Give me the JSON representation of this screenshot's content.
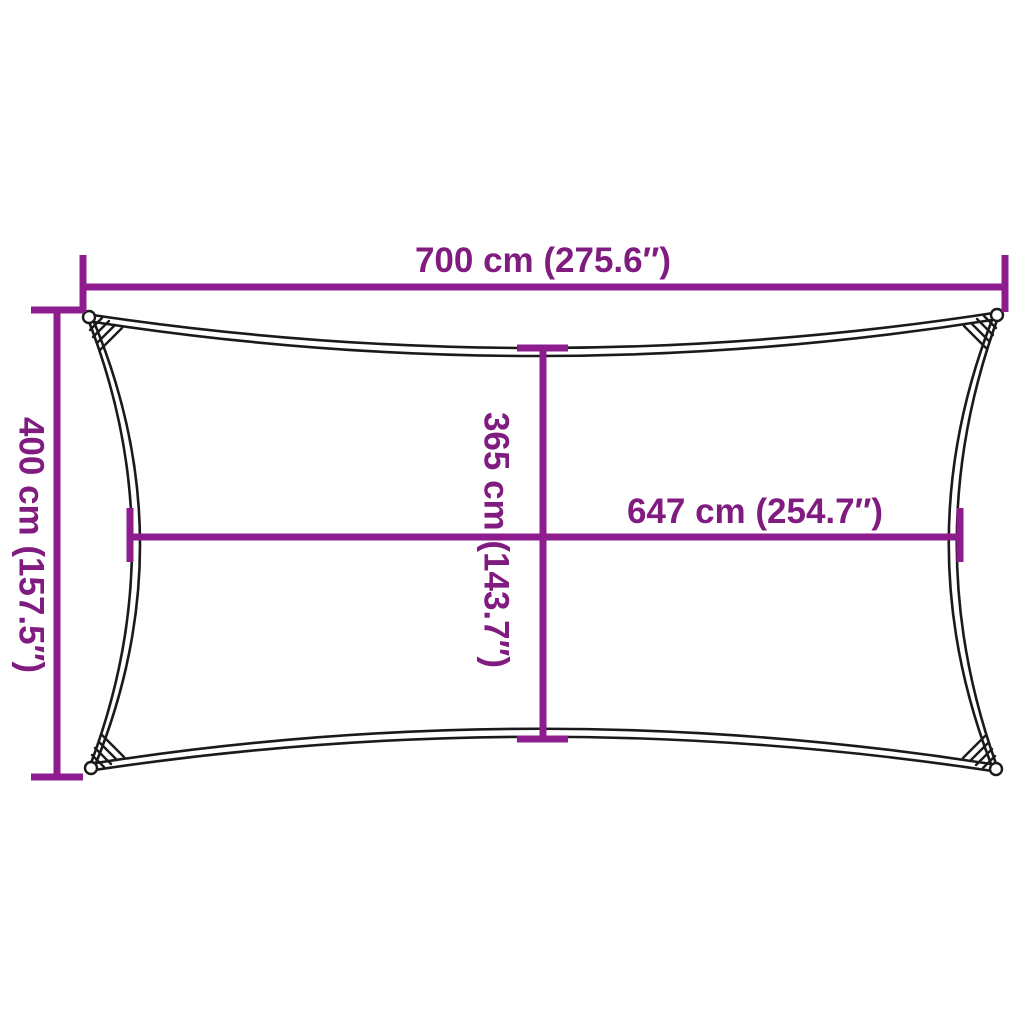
{
  "diagram": {
    "kind": "product-dimension-diagram",
    "shape": "rectangle-with-concave-edges"
  },
  "colors": {
    "background": "#FFFFFF",
    "dimension_line": "#8E1C8E",
    "dimension_text": "#801C80",
    "outline": "#1A1A1A"
  },
  "labels": {
    "width_top": "700 cm (275.6″)",
    "height_left": "400 cm (157.5″)",
    "inner_height": "365 cm (143.7″)",
    "inner_width": "647 cm (254.7″)"
  }
}
